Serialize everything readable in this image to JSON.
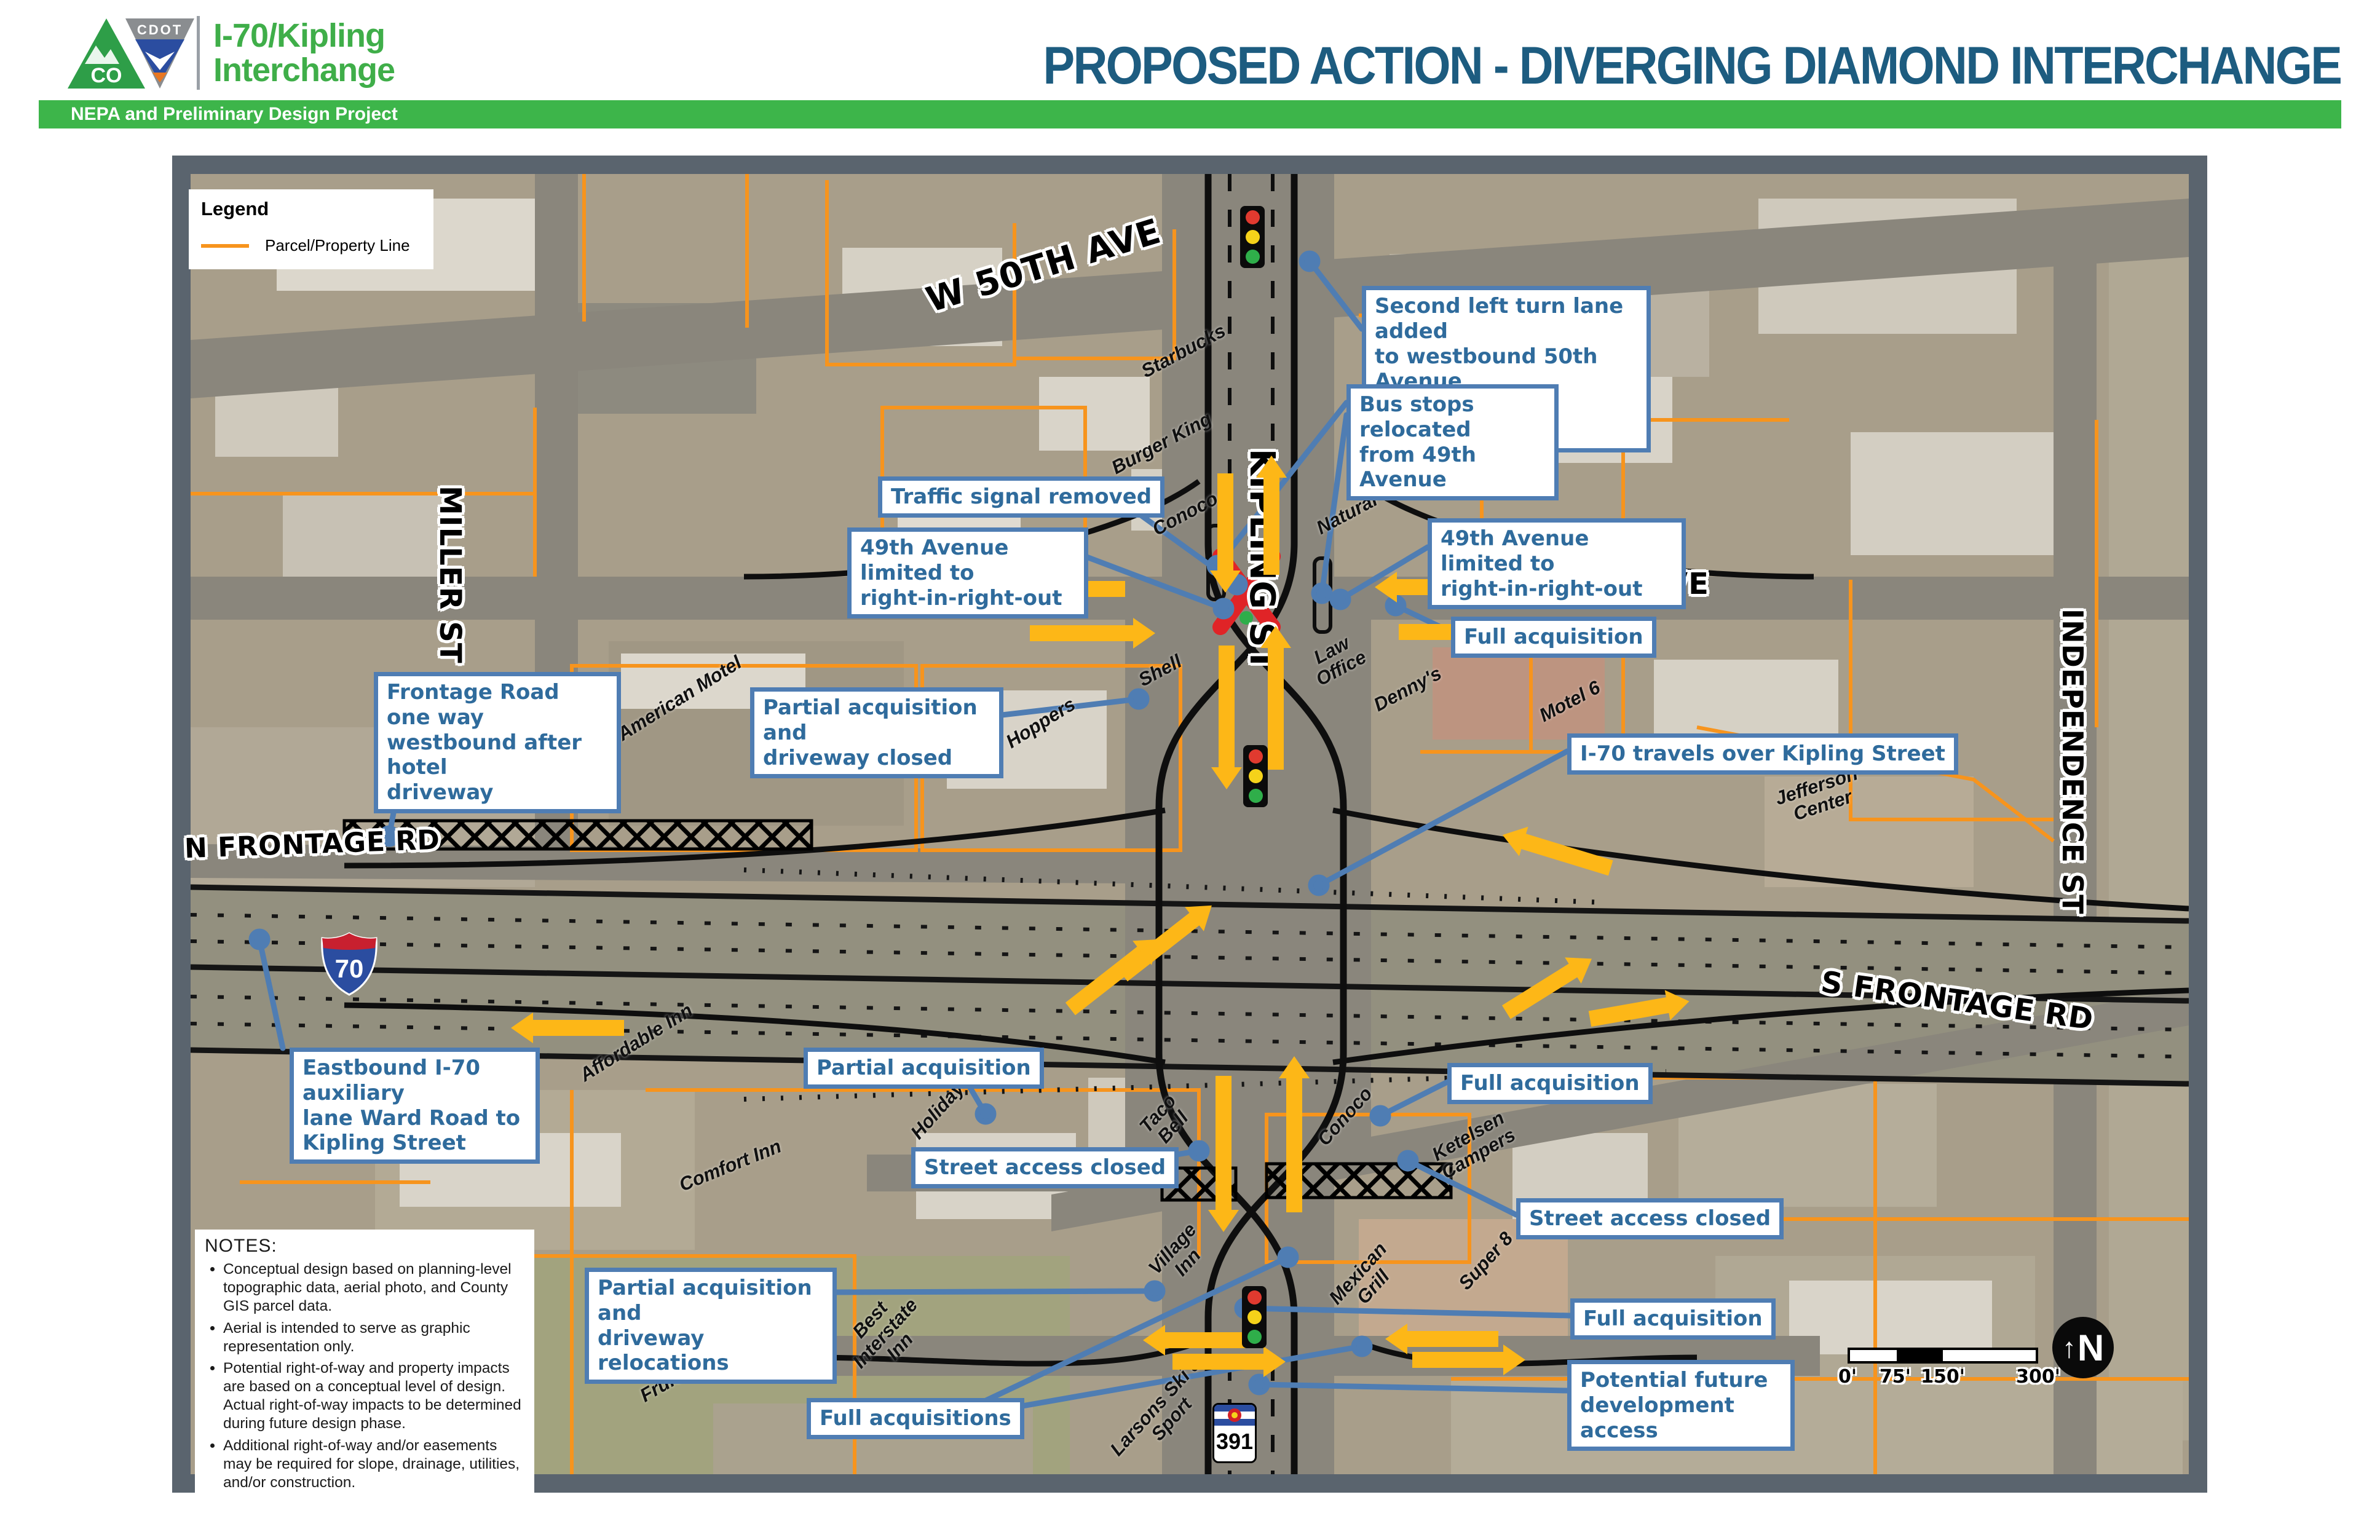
{
  "header": {
    "agency_logo": "CDOT Colorado logo",
    "project_title": "I-70/Kipling\nInterchange",
    "main_title": "PROPOSED ACTION - DIVERGING DIAMOND INTERCHANGE",
    "subtitle_bar": "NEPA and Preliminary Design Project"
  },
  "colors": {
    "green": "#3db54a",
    "title_teal": "#1d5c80",
    "parcel_orange": "#f7941d",
    "callout_blue_border": "#4f7db3",
    "callout_blue_text": "#2f6b9c",
    "arrow_yellow": "#fdb717"
  },
  "legend": {
    "title": "Legend",
    "items": [
      {
        "label": "Parcel/Property Line",
        "swatch_color": "#f7941d"
      }
    ]
  },
  "map": {
    "street_labels": [
      {
        "text": "W 50TH AVE"
      },
      {
        "text": "KIPLING ST"
      },
      {
        "text": "MILLER ST"
      },
      {
        "text": "W 49TH AVE"
      },
      {
        "text": "N FRONTAGE RD"
      },
      {
        "text": "S FRONTAGE RD"
      },
      {
        "text": "INDEPENDENCE ST"
      }
    ],
    "businesses": [
      {
        "text": "Starbucks"
      },
      {
        "text": "Burger King"
      },
      {
        "text": "Conoco"
      },
      {
        "text": "Natural Grocers"
      },
      {
        "text": "Law\nOffice"
      },
      {
        "text": "Denny's"
      },
      {
        "text": "Motel 6"
      },
      {
        "text": "Shell"
      },
      {
        "text": "American Motel"
      },
      {
        "text": "Hoppers"
      },
      {
        "text": "Jefferson\nCenter"
      },
      {
        "text": "Affordable Inn"
      },
      {
        "text": "Holiday Inn"
      },
      {
        "text": "Taco\nBell"
      },
      {
        "text": "Conoco"
      },
      {
        "text": "Comfort Inn"
      },
      {
        "text": "Ketelsen\nCampers"
      },
      {
        "text": "Village\nInn"
      },
      {
        "text": "Mexican\nGrill"
      },
      {
        "text": "Super 8"
      },
      {
        "text": "Best\nInterstate\nInn"
      },
      {
        "text": "Fruitdale Park"
      },
      {
        "text": "Larsons Ski &\nSport"
      }
    ],
    "callouts": [
      {
        "text": "Second left turn lane added\nto westbound 50th Avenue\nat Kipling Intersection"
      },
      {
        "text": "Bus stops relocated\nfrom 49th Avenue"
      },
      {
        "text": "Traffic signal removed"
      },
      {
        "text": "49th Avenue limited to\nright-in-right-out"
      },
      {
        "text": "49th Avenue limited to\nright-in-right-out"
      },
      {
        "text": "Full acquisition"
      },
      {
        "text": "Frontage Road one way\nwestbound after hotel\ndriveway"
      },
      {
        "text": "Partial acquisition and\ndriveway closed"
      },
      {
        "text": "I-70 travels over Kipling Street"
      },
      {
        "text": "Eastbound I-70 auxiliary\nlane Ward Road to\nKipling Street"
      },
      {
        "text": "Partial acquisition"
      },
      {
        "text": "Full acquisition"
      },
      {
        "text": "Street access closed"
      },
      {
        "text": "Street access closed"
      },
      {
        "text": "Partial acquisition and\ndriveway relocations"
      },
      {
        "text": "Full acquisition"
      },
      {
        "text": "Full acquisitions"
      },
      {
        "text": "Potential future\ndevelopment access"
      }
    ],
    "shields": {
      "interstate": "70",
      "state_route": "391"
    },
    "notes": {
      "title": "NOTES:",
      "bullets": [
        "Conceptual design based on planning-level topographic data, aerial photo, and County GIS parcel data.",
        "Aerial is intended to serve as graphic representation only.",
        "Potential right-of-way and property impacts are based on a conceptual level of design. Actual right-of-way impacts to be determined during future design phase.",
        "Additional right-of-way and/or easements may be required for slope, drainage, utilities, and/or construction."
      ]
    },
    "scale_bar": {
      "labels": [
        "0'",
        "75'",
        "150'",
        "300'"
      ]
    },
    "north_label": "N"
  }
}
